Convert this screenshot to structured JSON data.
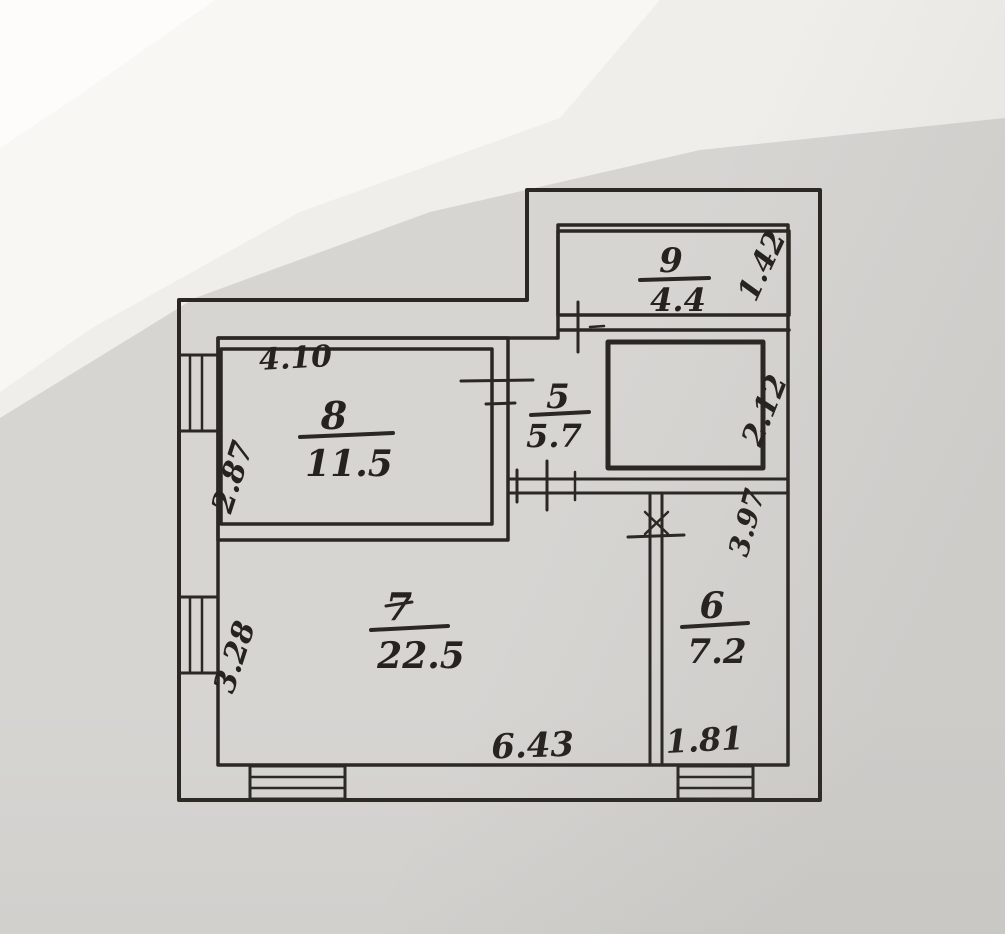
{
  "document": {
    "kind": "scanned hand-drawn apartment floor plan",
    "units_note": "room numbers over areas in m2, wall dimensions in meters"
  },
  "palette": {
    "paper": "#d6d5d2",
    "paper_light": "#efeeea",
    "paper_white": "#f8f7f3",
    "wall_fill": "#dcc0b5",
    "floor_fill": "#d9d7d3",
    "window_fill": "#edebe7",
    "ink": "#2b2823"
  },
  "rooms": [
    {
      "key": "room-9",
      "number": "9",
      "area": "4.4"
    },
    {
      "key": "room-8",
      "number": "8",
      "area": "11.5"
    },
    {
      "key": "room-5",
      "number": "5",
      "area": "5.7"
    },
    {
      "key": "room-7",
      "number": "7",
      "area": "22.5"
    },
    {
      "key": "room-6",
      "number": "6",
      "area": "7.2"
    }
  ],
  "dimensions": [
    {
      "key": "room8-width",
      "value": "4.10"
    },
    {
      "key": "room8-depth",
      "value": "2.87"
    },
    {
      "key": "room7-depth",
      "value": "3.28"
    },
    {
      "key": "room7-width",
      "value": "6.43"
    },
    {
      "key": "room6-width",
      "value": "1.81"
    },
    {
      "key": "room9-depth",
      "value": "1.42"
    },
    {
      "key": "bath-depth",
      "value": "2.12"
    },
    {
      "key": "right-mid",
      "value": "3.97"
    }
  ]
}
